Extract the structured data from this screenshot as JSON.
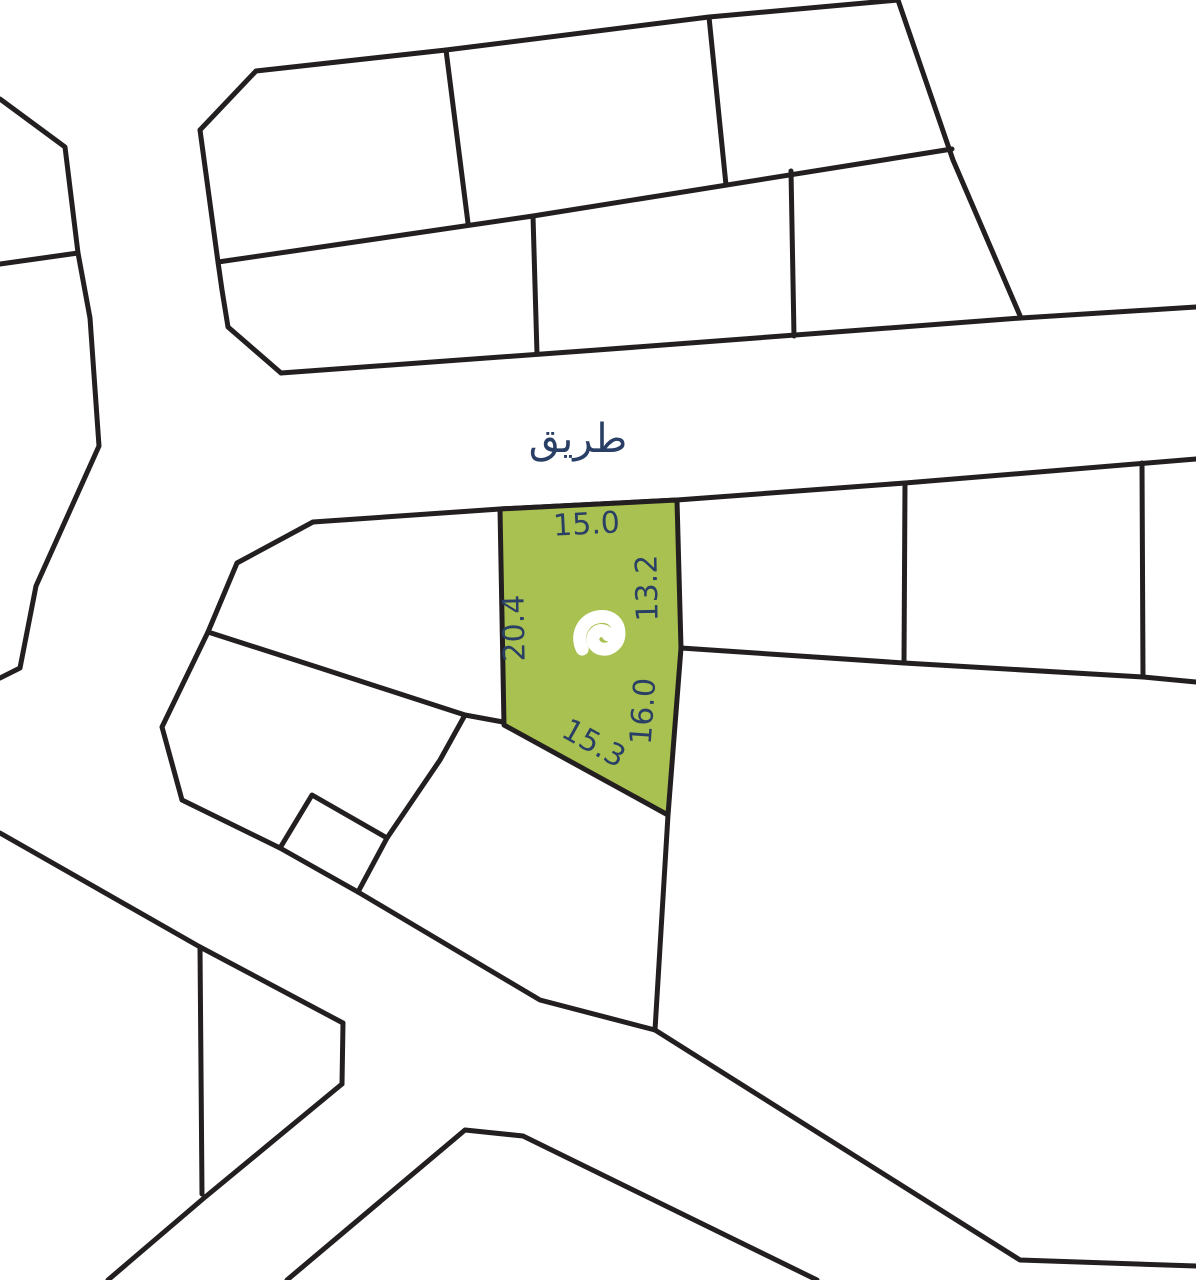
{
  "map": {
    "road": {
      "label": "طريق"
    },
    "highlighted_plot": {
      "logo_icon": "brand-mark",
      "dimensions": {
        "top": "15.0",
        "right_upper": "13.2",
        "right_lower": "16.0",
        "bottom": "15.3",
        "left": "20.4"
      }
    },
    "colors": {
      "plot_fill": "#a9c150",
      "line": "#231f20",
      "label": "#2a3f66",
      "background": "#ffffff"
    }
  }
}
